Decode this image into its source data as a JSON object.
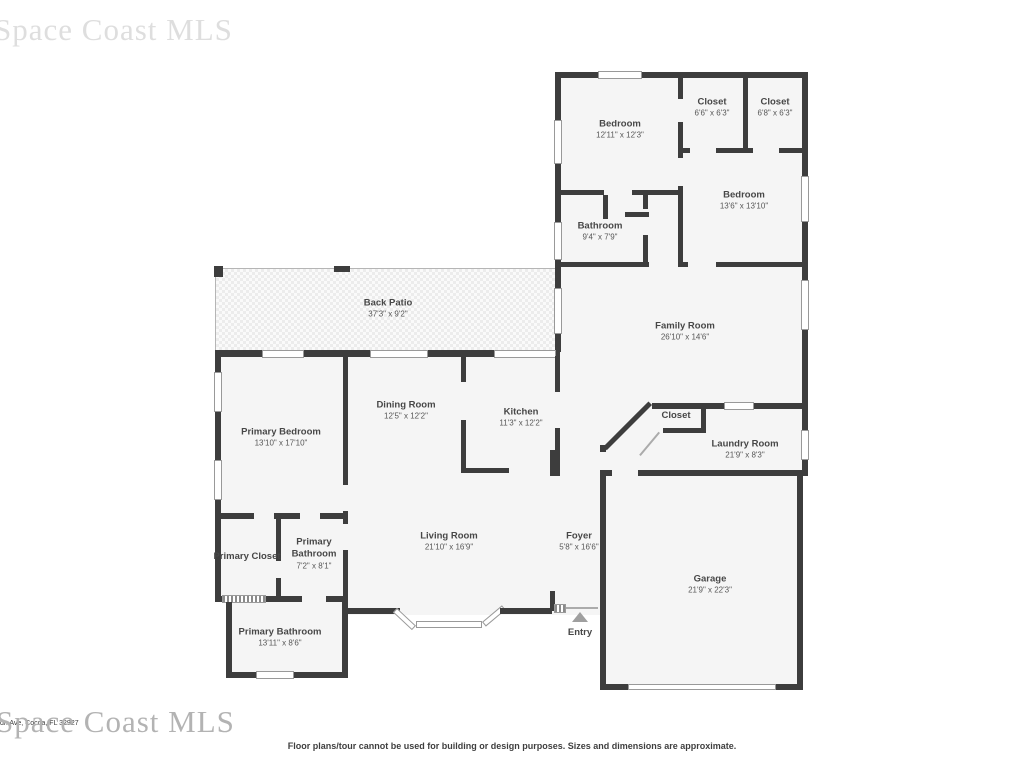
{
  "watermark": {
    "top": "Space Coast MLS",
    "bottom": "Space Coast MLS"
  },
  "address_line": "dr. Ave, Cocoa, FL 32927",
  "footer": {
    "disclaimer": "Floor plans/tour cannot be used for building or design purposes. Sizes and dimensions are approximate."
  },
  "entry": {
    "label": "Entry"
  },
  "colors": {
    "wall": "#3d3d3d",
    "room_fill": "#f5f5f5",
    "window_stroke": "#999999",
    "label_text": "#474747"
  },
  "rooms": {
    "bedroom1": {
      "name": "Bedroom",
      "dims": "12'11\" x 12'3\""
    },
    "closet1": {
      "name": "Closet",
      "dims": "6'6\" x 6'3\""
    },
    "closet2": {
      "name": "Closet",
      "dims": "6'8\" x 6'3\""
    },
    "bedroom2": {
      "name": "Bedroom",
      "dims": "13'6\" x 13'10\""
    },
    "bathroom": {
      "name": "Bathroom",
      "dims": "9'4\" x 7'9\""
    },
    "back_patio": {
      "name": "Back Patio",
      "dims": "37'3\" x 9'2\""
    },
    "family_room": {
      "name": "Family Room",
      "dims": "26'10\" x 14'6\""
    },
    "dining_room": {
      "name": "Dining Room",
      "dims": "12'5\" x 12'2\""
    },
    "kitchen": {
      "name": "Kitchen",
      "dims": "11'3\" x 12'2\""
    },
    "primary_bedroom": {
      "name": "Primary Bedroom",
      "dims": "13'10\" x 17'10\""
    },
    "closet3": {
      "name": "Closet",
      "dims": ""
    },
    "laundry_room": {
      "name": "Laundry Room",
      "dims": "21'9\" x 8'3\""
    },
    "living_room": {
      "name": "Living Room",
      "dims": "21'10\" x 16'9\""
    },
    "foyer": {
      "name": "Foyer",
      "dims": "5'8\" x 16'6\""
    },
    "garage": {
      "name": "Garage",
      "dims": "21'9\" x 22'3\""
    },
    "primary_closet": {
      "name": "Primary Closet",
      "dims": ""
    },
    "primary_bathroom1": {
      "name": "Primary Bathroom",
      "dims": "7'2\" x 8'1\""
    },
    "primary_bathroom2": {
      "name": "Primary Bathroom",
      "dims": "13'11\" x 8'6\""
    }
  }
}
